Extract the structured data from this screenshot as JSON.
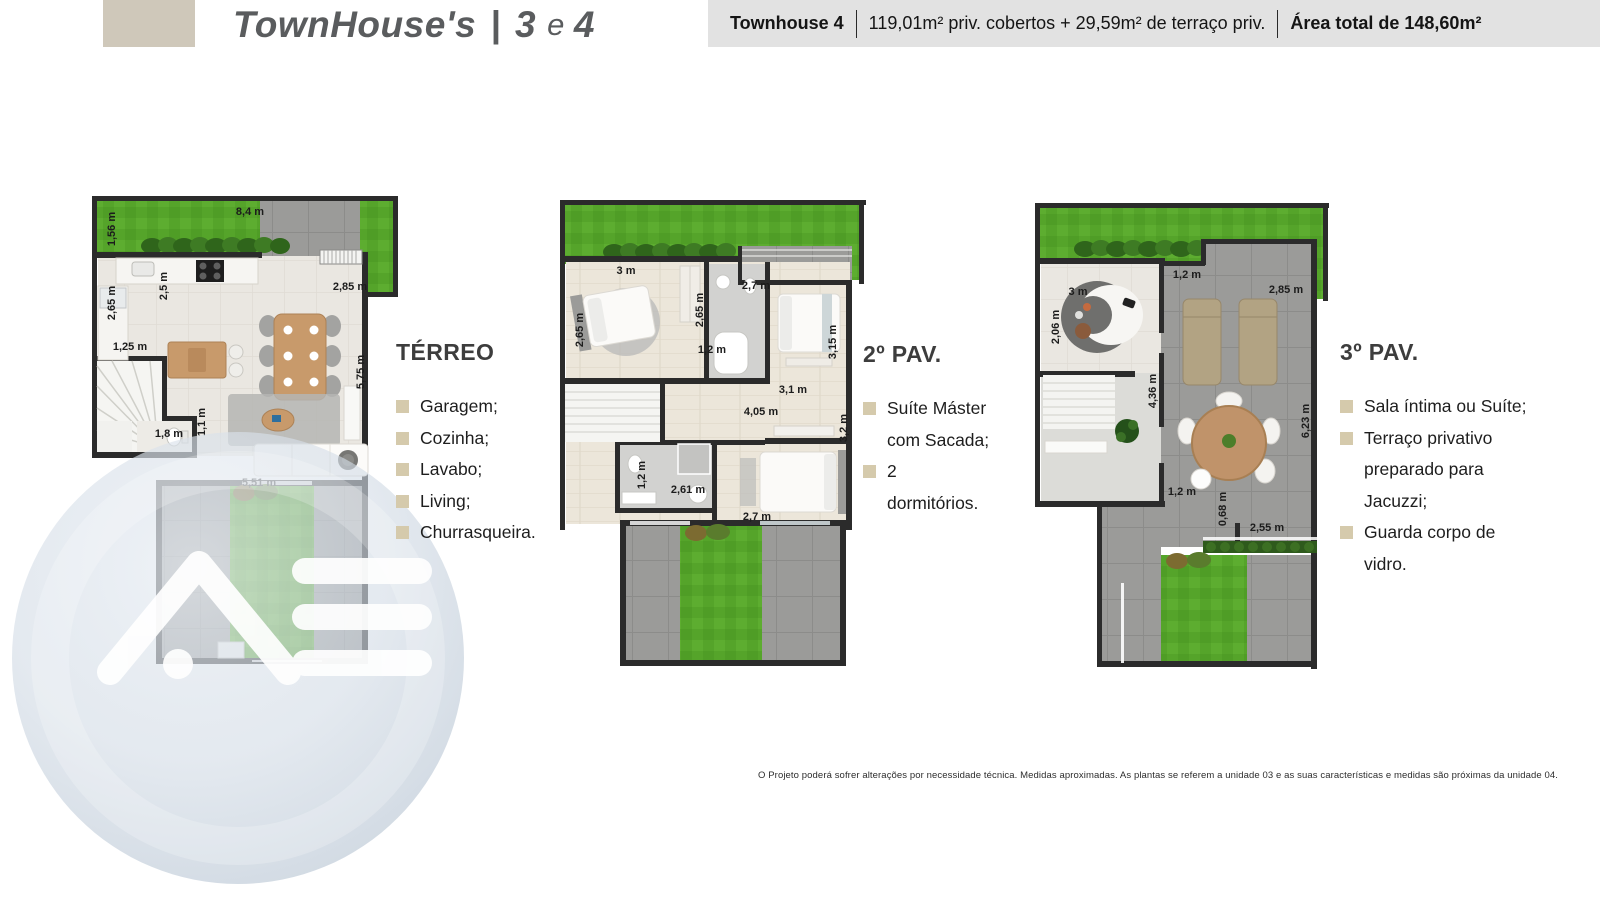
{
  "brand": {
    "title_name": "TownHouse's",
    "title_separator": "|",
    "title_num1": "3",
    "title_conj": "e",
    "title_num2": "4"
  },
  "header": {
    "unit": "Townhouse 4",
    "areas": "119,01m² priv. cobertos + 29,59m² de terraço priv.",
    "total": "Área total de 148,60m²"
  },
  "plans": [
    {
      "id": "terreo",
      "heading": "TÉRREO",
      "features": [
        "Garagem;",
        "Cozinha;",
        "Lavabo;",
        "Living;",
        "Churrasqueira."
      ],
      "measurements": [
        {
          "text": "8,4 m"
        },
        {
          "text": "1,56 m"
        },
        {
          "text": "2,5 m"
        },
        {
          "text": "2,65 m"
        },
        {
          "text": "1,25 m"
        },
        {
          "text": "2,85 m"
        },
        {
          "text": "5,75 m"
        },
        {
          "text": "1,8 m"
        },
        {
          "text": "1,1 m"
        },
        {
          "text": "5,51 m"
        }
      ]
    },
    {
      "id": "pav2",
      "heading": "2º PAV.",
      "features": [
        "Suíte Máster com Sacada;",
        "2 dormitórios."
      ],
      "measurements": [
        {
          "text": "3 m"
        },
        {
          "text": "2,65 m"
        },
        {
          "text": "2,65 m"
        },
        {
          "text": "1,2 m"
        },
        {
          "text": "2,7 m"
        },
        {
          "text": "3,15 m"
        },
        {
          "text": "3,1 m"
        },
        {
          "text": "4,05 m"
        },
        {
          "text": "3,2 m"
        },
        {
          "text": "1,2 m"
        },
        {
          "text": "2,61 m"
        },
        {
          "text": "2,7 m"
        }
      ]
    },
    {
      "id": "pav3",
      "heading": "3º PAV.",
      "features": [
        "Sala íntima ou Suíte;",
        "Terraço privativo preparado para Jacuzzi;",
        "Guarda corpo de vidro."
      ],
      "measurements": [
        {
          "text": "1,2 m"
        },
        {
          "text": "3 m"
        },
        {
          "text": "2,85 m"
        },
        {
          "text": "2,06 m"
        },
        {
          "text": "4,36 m"
        },
        {
          "text": "6,23 m"
        },
        {
          "text": "1,2 m"
        },
        {
          "text": "0,68 m"
        },
        {
          "text": "2,55 m"
        }
      ]
    }
  ],
  "watermark": {
    "letters": "AB"
  },
  "footer": {
    "disclaimer": "O Projeto poderá sofrer alterações por necessidade técnica. Medidas aproximadas. As plantas se referem a unidade 03 e as suas características e medidas são próximas da unidade 04."
  },
  "colors": {
    "accent_beige": "#cfc8ba",
    "bullet_beige": "#d5caac",
    "wall": "#2b2b2b",
    "grass": "#55a42a",
    "header_bg": "#e2e2e2"
  }
}
